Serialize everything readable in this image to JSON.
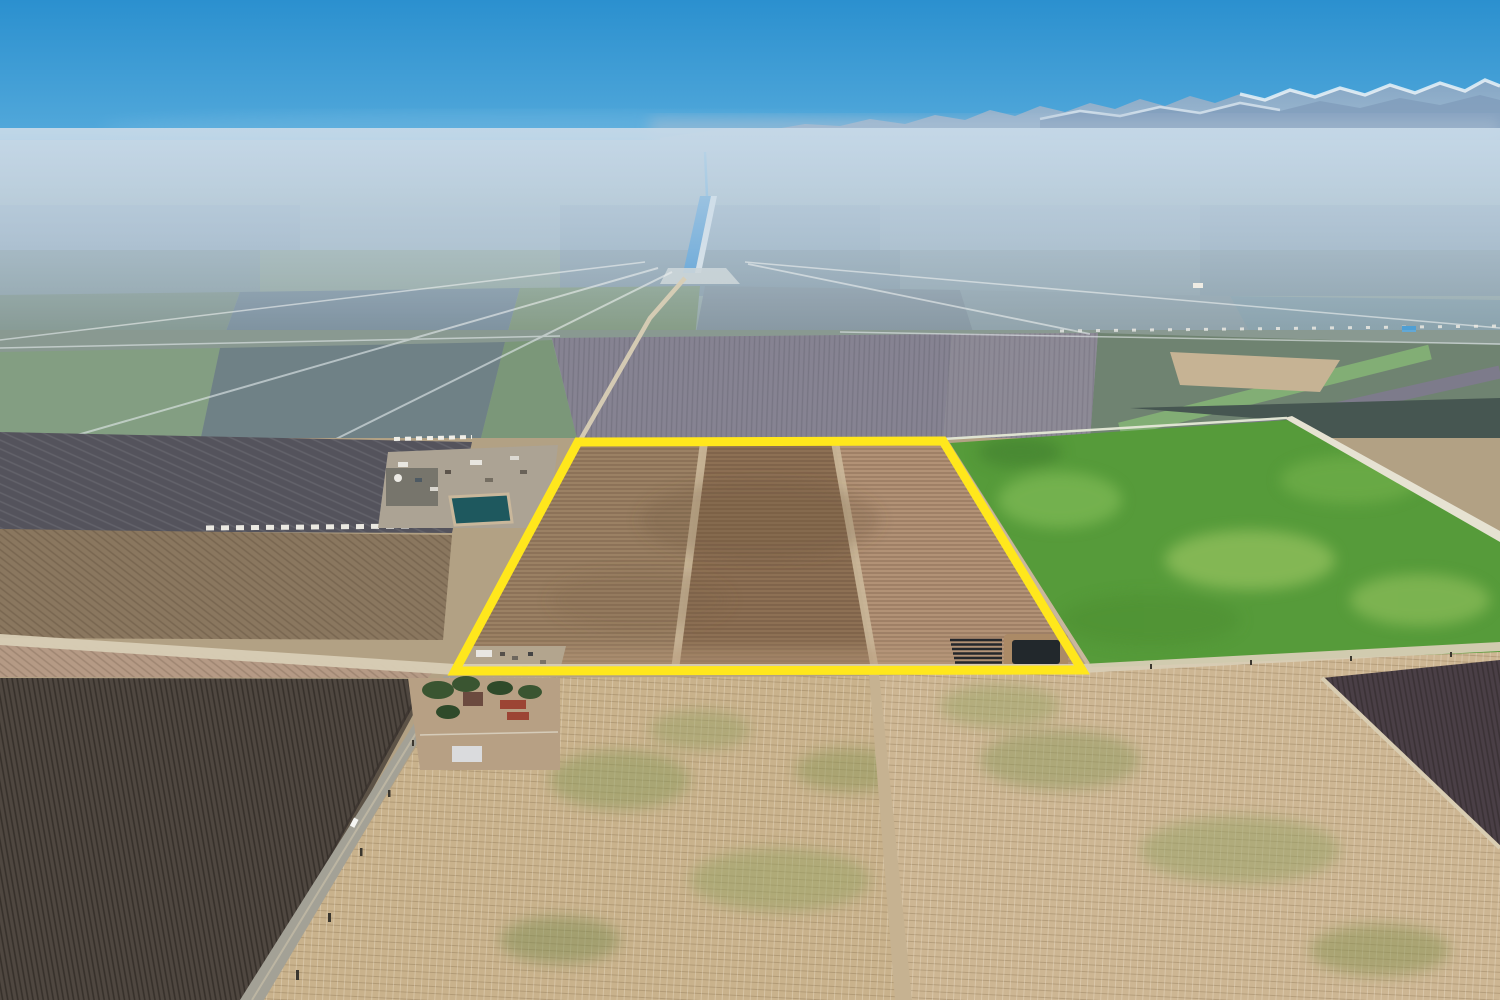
{
  "scene": {
    "type": "aerial-drone-photograph",
    "setting": "flat agricultural valley under hazy blue sky with snow-capped mountain range on the horizon",
    "visible_text": []
  },
  "palette": {
    "sky_top": "#2b90cf",
    "sky_mid": "#58acdc",
    "sky_low": "#8fc6e6",
    "sky_horizon": "#cadfee",
    "haze": "#c6d9e8",
    "mountain": "#8da7c2",
    "mountain_near": "#7f9bb9",
    "snow": "#f2f7fa",
    "distant_top": "#a7bbcc",
    "distant_low": "#8a9c96",
    "canal_water": "#3a8fd0",
    "orchard_center": "#7b7280",
    "orchard_center2": "#837a85",
    "plowed_dark": "#54535c",
    "orchard_brown": "#8a775f",
    "strip_pink": "#b59a85",
    "orchard_dark_bl": "#4f4740",
    "orchard_dark_br": "#4a3f46",
    "dark_green_field": "#2c3b31",
    "green_field": "#569b3a",
    "stubble_left": "#c9b28c",
    "stubble_right": "#cdb693",
    "road_tan": "#d8cdb5",
    "road_white": "#e6e2d2",
    "asphalt": "#a3a196",
    "dirt_road": "#c6b291",
    "parcel_west": "#9b8164",
    "parcel_middle": "#8d7054",
    "parcel_east": "#b29276",
    "parcel_path": "#cbb89a",
    "pond_water": "#22282c",
    "pond_bank": "#ab8a66",
    "facility_pad": "#aca394",
    "facility_pond": "#1e585e",
    "outline_yellow": "#ffe71c",
    "farmstead_yard": "#b7a084",
    "tree_green": "#3a5531",
    "barn_red": "#9c4434",
    "barn_white": "#dadbdd",
    "trailer_white": "#f4f2ea"
  },
  "parcel": {
    "outline_points": "578,442 943,441 1082,670 455,671",
    "outline_color": "#ffe71c",
    "outline_stroke_width": "9",
    "section_west_points": "578,442 703,442 675,670 455,671",
    "section_middle_points": "703,442 835,442 875,670 675,670",
    "section_east_points": "835,442 943,441 1082,670 875,670",
    "path1_points": "700,442 708,442 679,670 671,670",
    "path2_points": "831,442 839,442 879,670 871,670"
  },
  "regions": {
    "green_field_points": "950,443 1287,420 1500,537 1500,661 1092,667",
    "stubble_left_points": "458,678 869,676 903,1000 262,1000",
    "stubble_right_points": "878,676 1500,652 1500,1000 906,1000",
    "orchard_dark_bl_points": "0,678 428,679 252,1000 0,1000",
    "orchard_dark_br_points": "1322,678 1500,660 1500,848",
    "orchard_brown_points": "0,529 452,535 443,640 0,638",
    "strip_pink_points": "0,641 436,668 428,678 0,677",
    "plowed_dark_points": "0,432 472,442 452,533 0,531",
    "orchard_center_points": "552,338 952,334 943,441 578,442",
    "orchard_center2_points": "952,334 1098,333 1090,440 943,441",
    "dark_green_block_points": "1130,408 1500,398 1500,530 1292,421",
    "road_ew_points": "0,634 455,664 1082,664 1500,642 1500,651 1082,673 455,675 0,645",
    "road_ns_points": "444,676 457,676 264,1000 240,1000",
    "road_ne_points": "1284,418 1292,416 1500,531 1500,542",
    "road_dirt_points": "869,673 879,673 912,1000 895,1000",
    "canal_points": "700,196 711,196 695,273 683,273"
  }
}
